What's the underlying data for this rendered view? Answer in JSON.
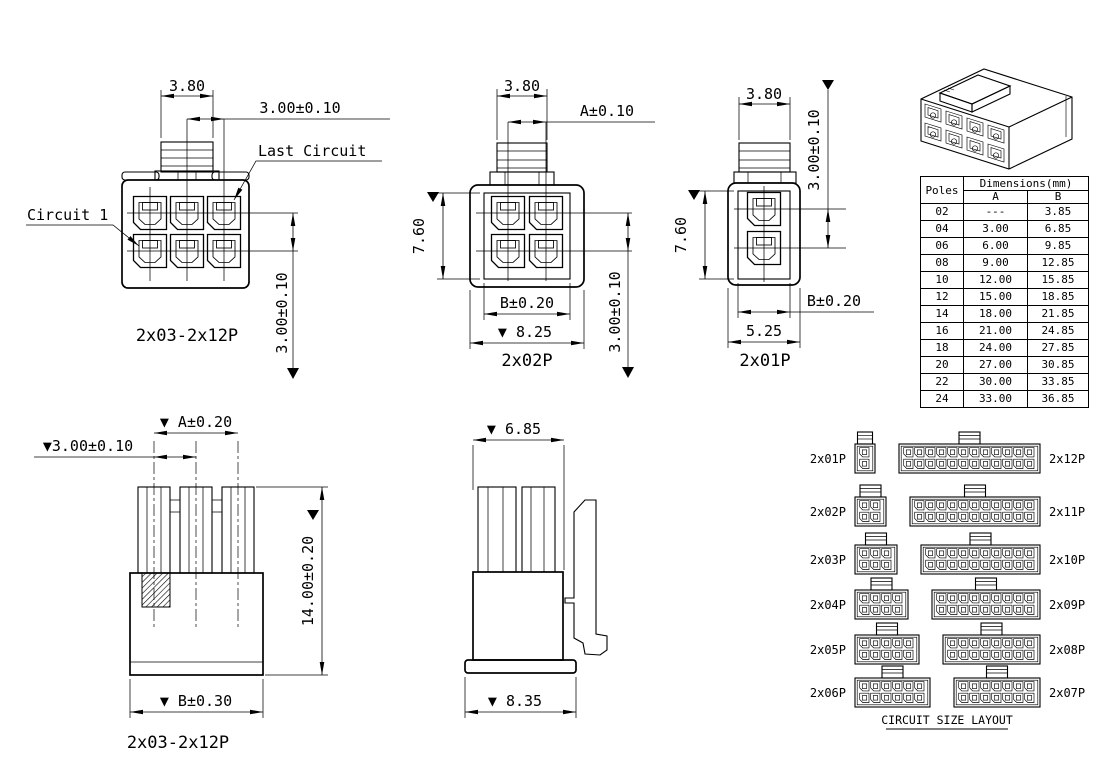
{
  "front_2x03": {
    "caption": "2x03-2x12P",
    "dim_top": "3.80",
    "dim_pitch_top": "3.00±0.10",
    "dim_pitch_right": "3.00±0.10",
    "label_first": "Circuit 1",
    "label_last": "Last Circuit"
  },
  "front_2x02": {
    "caption": "2x02P",
    "dim_top": "3.80",
    "dim_a": "A±0.10",
    "dim_height": "7.60",
    "dim_b": "B±0.20",
    "dim_overall": "▼ 8.25",
    "dim_pitch_right": "3.00±0.10"
  },
  "front_2x01": {
    "caption": "2x01P",
    "dim_top": "3.80",
    "dim_pitch_right": "3.00±0.10",
    "dim_height": "7.60",
    "dim_b": "B±0.20",
    "dim_overall": "5.25"
  },
  "rear_view": {
    "caption": "2x03-2x12P",
    "dim_a": "▼ A±0.20",
    "dim_pitch": "▼3.00±0.10",
    "dim_height": "14.00±0.20",
    "dim_b": "▼ B±0.30"
  },
  "side_view": {
    "dim_depth": "▼ 6.85",
    "dim_base": "▼ 8.35"
  },
  "poles_table": {
    "col_poles": "Poles",
    "col_group": "Dimensions(mm)",
    "col_a": "A",
    "col_b": "B",
    "rows": [
      [
        "02",
        "---",
        "3.85"
      ],
      [
        "04",
        "3.00",
        "6.85"
      ],
      [
        "06",
        "6.00",
        "9.85"
      ],
      [
        "08",
        "9.00",
        "12.85"
      ],
      [
        "10",
        "12.00",
        "15.85"
      ],
      [
        "12",
        "15.00",
        "18.85"
      ],
      [
        "14",
        "18.00",
        "21.85"
      ],
      [
        "16",
        "21.00",
        "24.85"
      ],
      [
        "18",
        "24.00",
        "27.85"
      ],
      [
        "20",
        "27.00",
        "30.85"
      ],
      [
        "22",
        "30.00",
        "33.85"
      ],
      [
        "24",
        "33.00",
        "36.85"
      ]
    ]
  },
  "circuit_layout": {
    "title": "CIRCUIT SIZE LAYOUT",
    "items": [
      {
        "label": "2x01P",
        "cols": 1,
        "row": 0,
        "side": "left"
      },
      {
        "label": "2x12P",
        "cols": 12,
        "row": 0,
        "side": "right"
      },
      {
        "label": "2x02P",
        "cols": 2,
        "row": 1,
        "side": "left"
      },
      {
        "label": "2x11P",
        "cols": 11,
        "row": 1,
        "side": "right"
      },
      {
        "label": "2x03P",
        "cols": 3,
        "row": 2,
        "side": "left"
      },
      {
        "label": "2x10P",
        "cols": 10,
        "row": 2,
        "side": "right"
      },
      {
        "label": "2x04P",
        "cols": 4,
        "row": 3,
        "side": "left"
      },
      {
        "label": "2x09P",
        "cols": 9,
        "row": 3,
        "side": "right"
      },
      {
        "label": "2x05P",
        "cols": 5,
        "row": 4,
        "side": "left"
      },
      {
        "label": "2x08P",
        "cols": 8,
        "row": 4,
        "side": "right"
      },
      {
        "label": "2x06P",
        "cols": 6,
        "row": 5,
        "side": "left"
      },
      {
        "label": "2x07P",
        "cols": 7,
        "row": 5,
        "side": "right"
      }
    ]
  }
}
